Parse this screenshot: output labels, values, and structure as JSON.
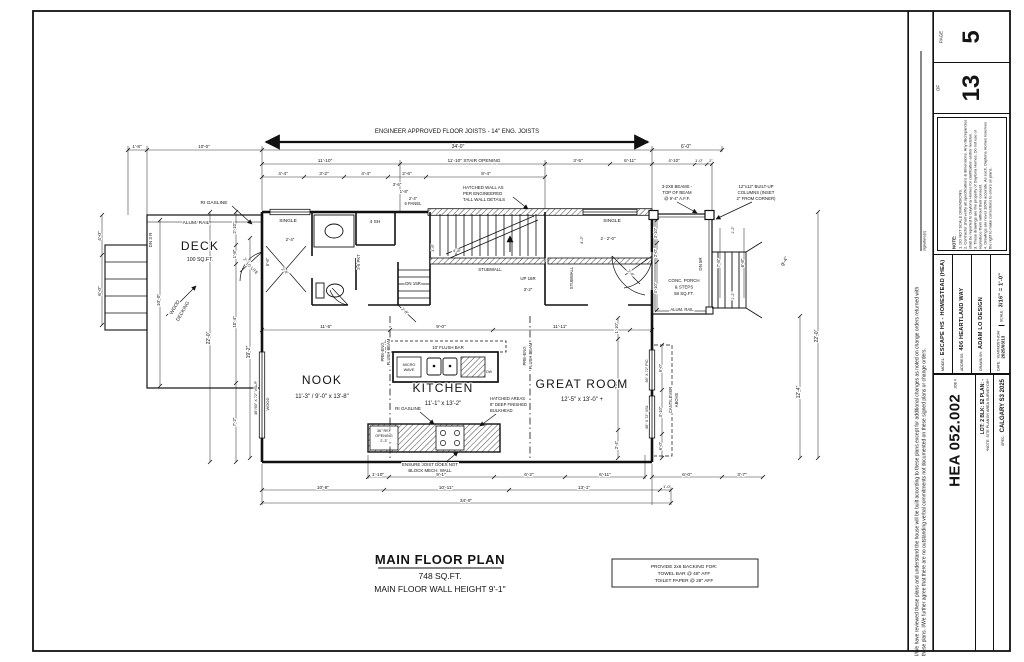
{
  "title_block": {
    "page_label": "PAGE",
    "page_number": "5",
    "of_label": "OF",
    "total_pages": "13",
    "notes_heading": "NOTE:",
    "notes": [
      "1. DO NOT SCALE DIMENSIONS.",
      "2. Contractor shall verify all specifications & dimensions. Any discrepancies shall be reported to Daytona Homes for clarification and/or revision.",
      "3. These drawings are the property of Daytona Homes. Do not use or reproduce them without their consent.",
      "4. Drawings are never 100% accurate. As such, Daytona Homes reserves the right to make corrections to errors on plans."
    ],
    "model_label": "MODEL:",
    "model_value": "ESCAPE HS - HOMESTEAD (HEA)",
    "address_label": "ADDRESS:",
    "address_value": "406 HEARTLAND WAY",
    "drawn_by_label": "DRAWN BY:",
    "drawn_by_value": "ADAM LO DESIGN",
    "scale_label": "SCALE:",
    "scale_value": "3/16\" = 1'-0\"",
    "date_label": "DATE:",
    "date_format": "YEAR/MONTH/DAY",
    "date_value": "2025/03/13",
    "job_label": "JOB #",
    "job_number": "HEA 052.002",
    "lot_line": "LOT: 2   BLK: 52   PLAN: -",
    "site_note": "*NOTE: SITE PLAN BY AREA SURVEYOR*",
    "spec_label": "SPEC:",
    "spec_value": "CALGARY S3 2025"
  },
  "disclaimer": {
    "text": "I/We have reviewed these plans and understand the house will be built according to these plans except for additional changes as noted on change orders returned with these plans. I/We further agree that there are no outstanding verbal commitments not documented on these signed plans or change orders.",
    "signature_label": "signature(s)"
  },
  "plan": {
    "annotations": [
      {
        "n": "joist-note",
        "t": "ENGINEER APPROVED FLOOR JOISTS   -   14\" ENG. JOISTS",
        "x": 457,
        "y": 133,
        "s": 6
      },
      {
        "t": "34'-0\"",
        "x": 458,
        "y": 148
      },
      {
        "t": "6'-0\"",
        "x": 686,
        "y": 148
      },
      {
        "t": "1'-8\"",
        "x": 137,
        "y": 148,
        "s": 4.6
      },
      {
        "t": "10'-0\"",
        "x": 204,
        "y": 148,
        "s": 4.6
      },
      {
        "t": "11'-10\"",
        "x": 325,
        "y": 162,
        "s": 4.8
      },
      {
        "t": "11'-10\" STAIR OPENING",
        "x": 474,
        "y": 162,
        "s": 4.8
      },
      {
        "t": "3'-5\"",
        "x": 578,
        "y": 162,
        "s": 4.8
      },
      {
        "t": "6'-11\"",
        "x": 630,
        "y": 162,
        "s": 4.8
      },
      {
        "t": "4'-10\"",
        "x": 674,
        "y": 162,
        "s": 4.4
      },
      {
        "t": "1'-0\"",
        "x": 699,
        "y": 162,
        "s": 4
      },
      {
        "t": "2\"",
        "x": 711,
        "y": 162,
        "s": 4
      },
      {
        "t": "4'-4\"",
        "x": 283,
        "y": 175,
        "s": 4.8
      },
      {
        "t": "3'-2\"",
        "x": 324,
        "y": 175,
        "s": 4.8
      },
      {
        "t": "4'-4\"",
        "x": 366,
        "y": 175,
        "s": 4.8
      },
      {
        "t": "2'-6\"",
        "x": 407,
        "y": 175,
        "s": 4.8
      },
      {
        "t": "8'-4\"",
        "x": 486,
        "y": 175,
        "s": 4.8
      },
      {
        "t": "3'-6\"",
        "x": 397,
        "y": 186,
        "s": 4.4
      },
      {
        "t": "1'-8\"",
        "x": 404,
        "y": 193,
        "s": 4.4
      },
      {
        "t": "2'-4\"",
        "x": 413,
        "y": 200,
        "s": 4.2
      },
      {
        "t": "6 PANEL",
        "x": 413,
        "y": 205,
        "s": 4.2
      },
      {
        "n": "hatched-wall-note",
        "t": "HATCHED WALL AS",
        "x": 463,
        "y": 189,
        "s": 4.4,
        "a": "start"
      },
      {
        "t": "PER ENGINEERED",
        "x": 463,
        "y": 195,
        "s": 4.4,
        "a": "start"
      },
      {
        "t": "TALL WALL DETAILS",
        "x": 463,
        "y": 201,
        "s": 4.4,
        "a": "start"
      },
      {
        "n": "beam-note",
        "t": "3-2X8 BEAMS -",
        "x": 677,
        "y": 188,
        "s": 4.3
      },
      {
        "t": "TOP OF BEAM",
        "x": 677,
        "y": 194,
        "s": 4.3
      },
      {
        "t": "@ 9'-4\" A.F.F.",
        "x": 677,
        "y": 200,
        "s": 4.3
      },
      {
        "n": "column-note",
        "t": "12\"x12\" BUILT-UP",
        "x": 756,
        "y": 188,
        "s": 4.3
      },
      {
        "t": "COLUMNS (INSET",
        "x": 756,
        "y": 194,
        "s": 4.3
      },
      {
        "t": "2\" FROM CORNER)",
        "x": 756,
        "y": 200,
        "s": 4.3
      },
      {
        "n": "ri-gasline-label",
        "t": "RI GASLINE",
        "x": 214,
        "y": 204,
        "s": 4.8
      },
      {
        "t": "ALUM. RAIL",
        "x": 196,
        "y": 224,
        "s": 4.8
      },
      {
        "n": "room-label-deck",
        "t": "DECK",
        "x": 200,
        "y": 250,
        "s": 12,
        "ls": 1.2
      },
      {
        "t": "100 SQ.FT.",
        "x": 200,
        "y": 261,
        "s": 5.2
      },
      {
        "t": "WOOD",
        "x": 176,
        "y": 308,
        "r": -60,
        "s": 4.8
      },
      {
        "t": "DECKING",
        "x": 184,
        "y": 312,
        "r": -60,
        "s": 4.8
      },
      {
        "t": "DN 3 R",
        "x": 152,
        "y": 240,
        "r": -90,
        "s": 4.5
      },
      {
        "t": "10'-0\"",
        "x": 160,
        "y": 300,
        "r": -90,
        "s": 4.8
      },
      {
        "t": "4'-0\"",
        "x": 101,
        "y": 236,
        "r": -90,
        "s": 4.8
      },
      {
        "t": "6'-0\"",
        "x": 101,
        "y": 291,
        "r": -90,
        "s": 4.8
      },
      {
        "n": "door-label",
        "t": "2'-8\"",
        "x": 246,
        "y": 262,
        "r": 45,
        "s": 4
      },
      {
        "t": "1/2 LITE",
        "x": 251,
        "y": 269,
        "r": 45,
        "s": 4
      },
      {
        "t": "2'-10\"",
        "x": 236,
        "y": 228,
        "r": -90,
        "s": 4.4
      },
      {
        "t": "1'-8\"",
        "x": 236,
        "y": 254,
        "r": -90,
        "s": 4.4
      },
      {
        "t": "10'-4\"",
        "x": 236,
        "y": 322,
        "r": -90,
        "s": 4.4
      },
      {
        "t": "7'-2\"",
        "x": 236,
        "y": 422,
        "r": -90,
        "s": 4.4
      },
      {
        "t": "22'-0\"",
        "x": 210,
        "y": 338,
        "r": -90,
        "s": 5
      },
      {
        "t": "19'-2\"",
        "x": 250,
        "y": 352,
        "r": -90,
        "s": 5
      },
      {
        "n": "window-label",
        "t": "36\"/60\" X 72\" VSL/F",
        "x": 257,
        "y": 398,
        "r": -90,
        "s": 3.8
      },
      {
        "t": "WOOD",
        "x": 269,
        "y": 404,
        "r": -90,
        "s": 4
      },
      {
        "n": "window-label",
        "t": "SINGLE",
        "x": 288,
        "y": 222,
        "s": 4.8
      },
      {
        "t": "2'-4\"",
        "x": 290,
        "y": 241,
        "s": 4.4
      },
      {
        "t": "5'-6\"",
        "x": 269,
        "y": 262,
        "r": -90,
        "s": 4.2
      },
      {
        "n": "door-label",
        "t": "2-6 PKT",
        "x": 360,
        "y": 262,
        "r": -90,
        "s": 4.2
      },
      {
        "t": "4 SH",
        "x": 375,
        "y": 223,
        "s": 4.8
      },
      {
        "t": "2'-4\"",
        "x": 284,
        "y": 272,
        "r": 45,
        "s": 4
      },
      {
        "t": "DN 15R",
        "x": 413,
        "y": 285,
        "s": 4.4
      },
      {
        "t": "UP 16R",
        "x": 528,
        "y": 280,
        "s": 4.4
      },
      {
        "t": "3'-2\"",
        "x": 528,
        "y": 291,
        "s": 4.4
      },
      {
        "t": "STUBWALL",
        "x": 490,
        "y": 271,
        "s": 4.4
      },
      {
        "t": "STUBWALL",
        "x": 573,
        "y": 278,
        "r": -90,
        "s": 4.2
      },
      {
        "t": "1'-6\"",
        "x": 434,
        "y": 248,
        "r": -90,
        "s": 4
      },
      {
        "t": "4'-8\"",
        "x": 457,
        "y": 252,
        "s": 4
      },
      {
        "t": "2'-8\"",
        "x": 404,
        "y": 312,
        "r": 45,
        "s": 4
      },
      {
        "n": "window-label",
        "t": "SINGLE",
        "x": 612,
        "y": 222,
        "s": 4.8
      },
      {
        "t": "2 - 2'-0\"",
        "x": 608,
        "y": 240,
        "s": 4.4
      },
      {
        "t": "2'-4\"",
        "x": 630,
        "y": 274,
        "r": 45,
        "s": 4
      },
      {
        "t": "4'-2\"",
        "x": 583,
        "y": 240,
        "r": -90,
        "s": 4
      },
      {
        "t": "CONC. PORCH",
        "x": 684,
        "y": 282,
        "s": 4.4
      },
      {
        "t": "& STEPS",
        "x": 684,
        "y": 288.5,
        "s": 4.4
      },
      {
        "t": "58 SQ.FT.",
        "x": 684,
        "y": 295,
        "s": 4.4
      },
      {
        "t": "ALUM. RAIL",
        "x": 682,
        "y": 311,
        "s": 4.2
      },
      {
        "t": "DN 5R",
        "x": 702,
        "y": 264,
        "r": -90,
        "s": 4.4
      },
      {
        "t": "3'-10\"",
        "x": 657,
        "y": 233,
        "r": -90,
        "s": 4.2
      },
      {
        "t": "2'-0\"",
        "x": 657,
        "y": 253,
        "r": -90,
        "s": 4.2
      },
      {
        "t": "4'-10\"",
        "x": 657,
        "y": 288,
        "r": -90,
        "s": 4.2
      },
      {
        "t": "7'-8\"",
        "x": 720,
        "y": 263,
        "r": -90,
        "s": 4.4
      },
      {
        "t": "6'-8\"",
        "x": 744,
        "y": 263,
        "r": -90,
        "s": 4.4
      },
      {
        "t": "1'-2\"",
        "x": 734,
        "y": 230,
        "r": -90,
        "s": 3.8
      },
      {
        "t": "1'-2\"",
        "x": 734,
        "y": 296,
        "r": -90,
        "s": 3.8
      },
      {
        "t": "9'-4\"",
        "x": 786,
        "y": 262,
        "r": -65,
        "s": 5
      },
      {
        "t": "12'-4\"",
        "x": 800,
        "y": 392,
        "r": -90,
        "s": 5
      },
      {
        "t": "22'-0\"",
        "x": 818,
        "y": 336,
        "r": -90,
        "s": 5
      },
      {
        "t": "CANTILEVER",
        "x": 672,
        "y": 400,
        "r": -90,
        "s": 4.2
      },
      {
        "t": "ABOVE",
        "x": 678,
        "y": 400,
        "r": -90,
        "s": 4.2
      },
      {
        "n": "window-label",
        "t": "36\" X 72\" PIC",
        "x": 648,
        "y": 371,
        "r": -90,
        "s": 3.8
      },
      {
        "n": "window-label",
        "t": "36\" X 72\" VSL",
        "x": 648,
        "y": 417,
        "r": -90,
        "s": 3.8
      },
      {
        "t": "6'-0\"",
        "x": 662,
        "y": 368,
        "r": -90,
        "s": 4.2
      },
      {
        "t": "3'-10\"",
        "x": 662,
        "y": 412,
        "r": -90,
        "s": 4.2
      },
      {
        "t": "6'-0\"",
        "x": 662,
        "y": 446,
        "r": -90,
        "s": 4.2
      },
      {
        "t": "1'-10\"",
        "x": 618,
        "y": 328,
        "r": -90,
        "s": 4.2
      },
      {
        "t": "7'-8\"",
        "x": 618,
        "y": 385,
        "r": -90,
        "s": 4.2
      },
      {
        "t": "2'-4\"",
        "x": 618,
        "y": 445,
        "r": -90,
        "s": 4.2
      },
      {
        "t": "11'-5\"",
        "x": 326,
        "y": 328,
        "s": 4.8
      },
      {
        "t": "9'-0\"",
        "x": 441,
        "y": 328,
        "s": 4.8
      },
      {
        "t": "11'-11\"",
        "x": 560,
        "y": 328,
        "s": 4.8
      },
      {
        "n": "room-label-nook",
        "t": "NOOK",
        "x": 322,
        "y": 384,
        "s": 12,
        "ls": 1.2
      },
      {
        "t": "11'-3\" / 9'-0\" x 13'-8\"",
        "x": 322,
        "y": 398,
        "s": 6
      },
      {
        "n": "room-label-kitchen",
        "t": "KITCHEN",
        "x": 443,
        "y": 392,
        "s": 12,
        "ls": 1.2
      },
      {
        "t": "11'-1\" x 13'-2\"",
        "x": 443,
        "y": 405,
        "s": 6
      },
      {
        "n": "room-label-great-room",
        "t": "GREAT ROOM",
        "x": 582,
        "y": 388,
        "s": 12,
        "ls": 1.2
      },
      {
        "t": "12'-5\" x 13'-0\" +",
        "x": 582,
        "y": 401,
        "s": 6
      },
      {
        "t": "PRE-ENG",
        "x": 384,
        "y": 352,
        "r": -90,
        "s": 4.2
      },
      {
        "t": "FLUSH BEAM",
        "x": 390,
        "y": 352,
        "r": -90,
        "s": 4.2
      },
      {
        "t": "PRE-ENG",
        "x": 526,
        "y": 356,
        "r": -90,
        "s": 4.2
      },
      {
        "t": "FLUSH BEAM",
        "x": 532,
        "y": 356,
        "r": -90,
        "s": 4.2
      },
      {
        "t": "10' FLUSH BAR",
        "x": 448,
        "y": 349,
        "s": 4.4
      },
      {
        "t": "MICRO",
        "x": 409,
        "y": 366,
        "s": 3.8
      },
      {
        "t": "WAVE",
        "x": 409,
        "y": 371,
        "s": 3.8
      },
      {
        "t": "DW",
        "x": 489,
        "y": 373,
        "s": 3.5
      },
      {
        "n": "ri-gasline-label",
        "t": "RI GASLINE",
        "x": 408,
        "y": 410,
        "s": 4.6
      },
      {
        "n": "bulkhead-note",
        "t": "HATCHED AREAS",
        "x": 490,
        "y": 400,
        "s": 4.2,
        "a": "start"
      },
      {
        "t": "8\" DEEP FINISHED",
        "x": 490,
        "y": 406,
        "s": 4.2,
        "a": "start"
      },
      {
        "t": "BULKHEAD",
        "x": 490,
        "y": 412,
        "s": 4.2,
        "a": "start"
      },
      {
        "t": "36\" REF",
        "x": 384,
        "y": 432,
        "s": 3.8
      },
      {
        "t": "OPENING",
        "x": 384,
        "y": 437,
        "s": 3.8
      },
      {
        "t": "2'-3\"",
        "x": 384,
        "y": 442,
        "s": 3.8
      },
      {
        "n": "joist-warning",
        "t": "ENSURE JOIST DOES NOT",
        "x": 430,
        "y": 466,
        "s": 4.4
      },
      {
        "t": "BLOCK MECH. WALL",
        "x": 430,
        "y": 472,
        "s": 4.4
      },
      {
        "t": "1'-10\"",
        "x": 378,
        "y": 476,
        "s": 4.8
      },
      {
        "t": "9'-1\"",
        "x": 441,
        "y": 476,
        "s": 4.8
      },
      {
        "t": "6'-2\"",
        "x": 529,
        "y": 476,
        "s": 4.8
      },
      {
        "t": "6'-11\"",
        "x": 605,
        "y": 476,
        "s": 4.8
      },
      {
        "t": "6'-0\"",
        "x": 687,
        "y": 476,
        "s": 4.8
      },
      {
        "t": "3'-7\"",
        "x": 742,
        "y": 476,
        "s": 4.8
      },
      {
        "t": "10'-8\"",
        "x": 323,
        "y": 489,
        "s": 4.8
      },
      {
        "t": "10'-11\"",
        "x": 446,
        "y": 489,
        "s": 4.8
      },
      {
        "t": "13'-1\"",
        "x": 584,
        "y": 489,
        "s": 4.8
      },
      {
        "t": "1'-0\"",
        "x": 667,
        "y": 488,
        "s": 4
      },
      {
        "t": "34'-0\"",
        "x": 466,
        "y": 502,
        "s": 4.8
      },
      {
        "n": "plan-title",
        "t": "MAIN FLOOR PLAN",
        "x": 440,
        "y": 564,
        "s": 13,
        "b": 1,
        "ls": 0.6
      },
      {
        "n": "plan-area",
        "t": "748 SQ.FT.",
        "x": 440,
        "y": 579,
        "s": 8.5
      },
      {
        "n": "plan-wall-height",
        "t": "MAIN FLOOR WALL HEIGHT 9'-1\"",
        "x": 440,
        "y": 592,
        "s": 8.5
      },
      {
        "n": "backing-note",
        "t": "PROVIDE 2x6 BACKING FOR:",
        "x": 684,
        "y": 568,
        "s": 4.8
      },
      {
        "t": "TOWEL BAR @ 48\" AFF",
        "x": 684,
        "y": 575,
        "s": 4.8
      },
      {
        "t": "TOILET PAPER @ 28\" AFF",
        "x": 684,
        "y": 582,
        "s": 4.8
      }
    ]
  }
}
